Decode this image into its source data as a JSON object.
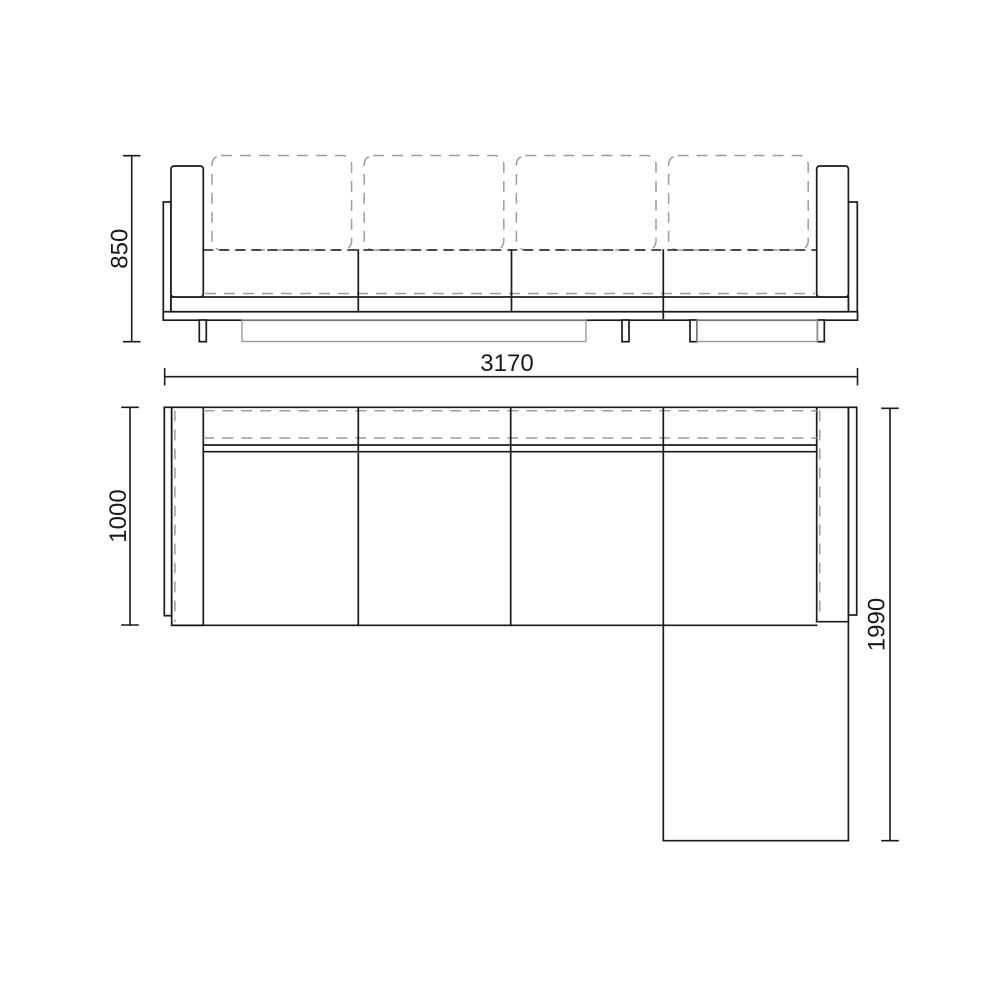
{
  "drawing": {
    "dimensions": {
      "height": "850",
      "width": "3170",
      "depth": "1000",
      "chaise_length": "1990"
    },
    "colors": {
      "line": "#1b1b1b",
      "hidden_line": "#9c9c9c",
      "background": "#ffffff"
    }
  }
}
